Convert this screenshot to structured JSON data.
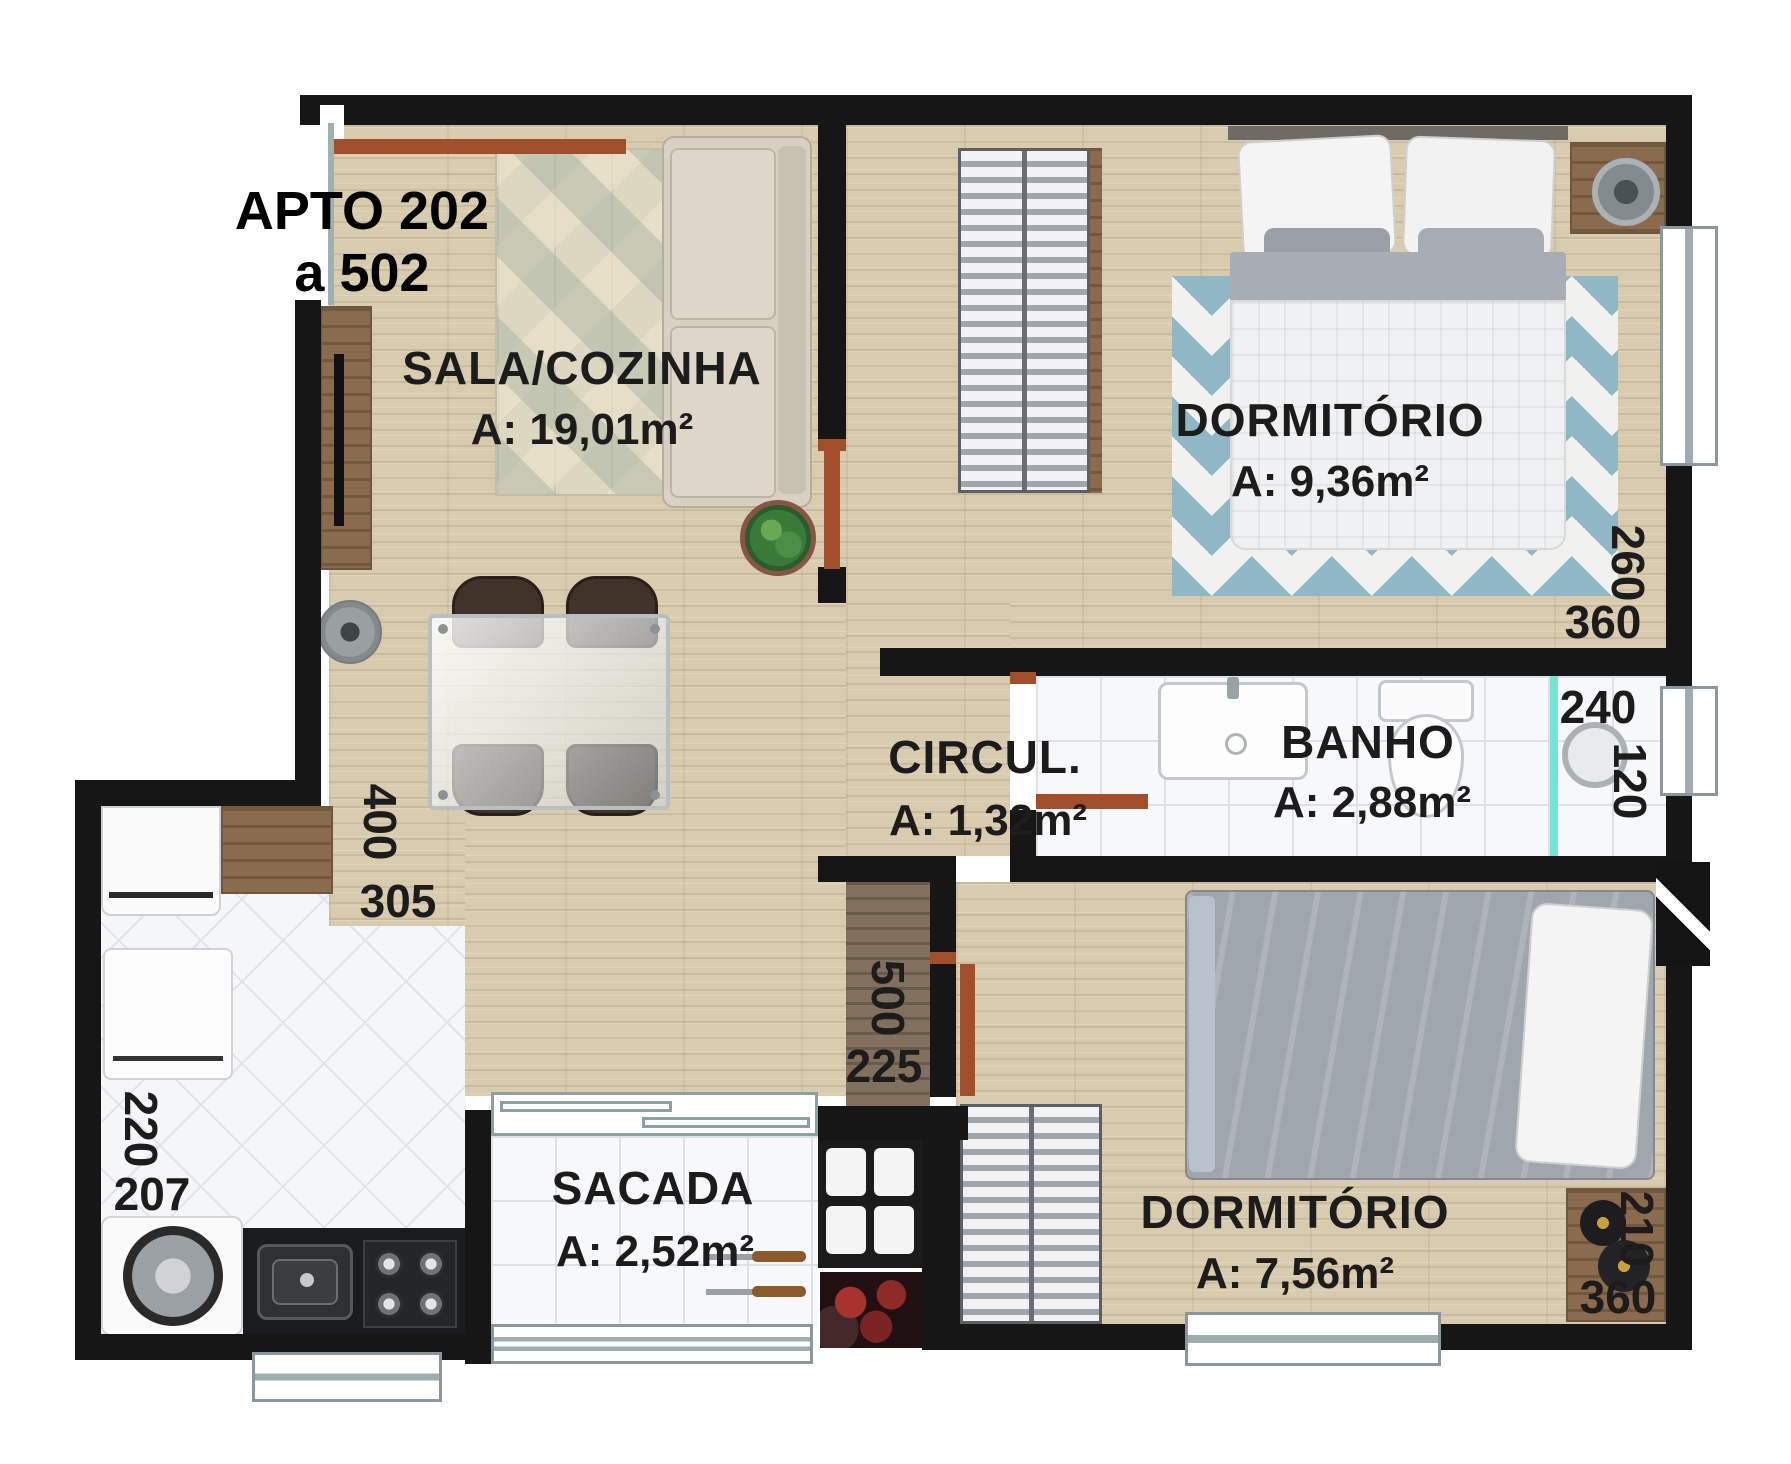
{
  "title": {
    "line1": "APTO 202",
    "line2": "a 502"
  },
  "rooms": {
    "sala": {
      "name": "SALA/COZINHA",
      "area": "A: 19,01m²"
    },
    "dorm1": {
      "name": "DORMITÓRIO",
      "area": "A: 9,36m²"
    },
    "circul": {
      "name": "CIRCUL.",
      "area": "A: 1,32m²"
    },
    "banho": {
      "name": "BANHO",
      "area": "A: 2,88m²"
    },
    "dorm2": {
      "name": "DORMITÓRIO",
      "area": "A: 7,56m²"
    },
    "sacada": {
      "name": "SACADA",
      "area": "A: 2,52m²"
    }
  },
  "dimensions": {
    "sala_v": "400",
    "sala_h": "305",
    "kitchen_v": "220",
    "kitchen_h": "207",
    "hall_v": "500",
    "hall_h": "225",
    "dorm1_v": "260",
    "dorm1_h": "360",
    "banho_h": "240",
    "banho_v": "120",
    "dorm2_v": "210",
    "dorm2_h": "360"
  },
  "furniture": {
    "sala": [
      "tv-cabinet",
      "tv",
      "geometric-rug",
      "sofa",
      "potted-plant",
      "dining-table",
      "four-chairs",
      "decor-vase",
      "entry-door"
    ],
    "kitchen": [
      "dishwasher",
      "wood-counter",
      "fridge",
      "washing-machine",
      "granite-counter",
      "kitchen-sink",
      "cooktop"
    ],
    "dorm1": [
      "slatted-wardrobe",
      "double-bed",
      "pillows",
      "chevron-rug",
      "nightstand",
      "table-lamp",
      "window"
    ],
    "banho": [
      "washbasin",
      "toilet",
      "shower-head",
      "glass-partition",
      "window"
    ],
    "dorm2": [
      "slatted-wardrobe",
      "single-bed",
      "pillow",
      "nightstand",
      "black-lamp",
      "window"
    ],
    "sacada": [
      "barbecue-grill",
      "charcoal-tray",
      "skewers",
      "railing",
      "sliding-door"
    ]
  },
  "colors": {
    "wall": "#161616",
    "wood_floor": "#d8cbae",
    "tile_floor": "#f7f8fa",
    "door": "#a14e2b",
    "shower_glass": "#74e3d2",
    "rug_chevron": "#8fb7c6",
    "text": "#1c1c1c"
  }
}
